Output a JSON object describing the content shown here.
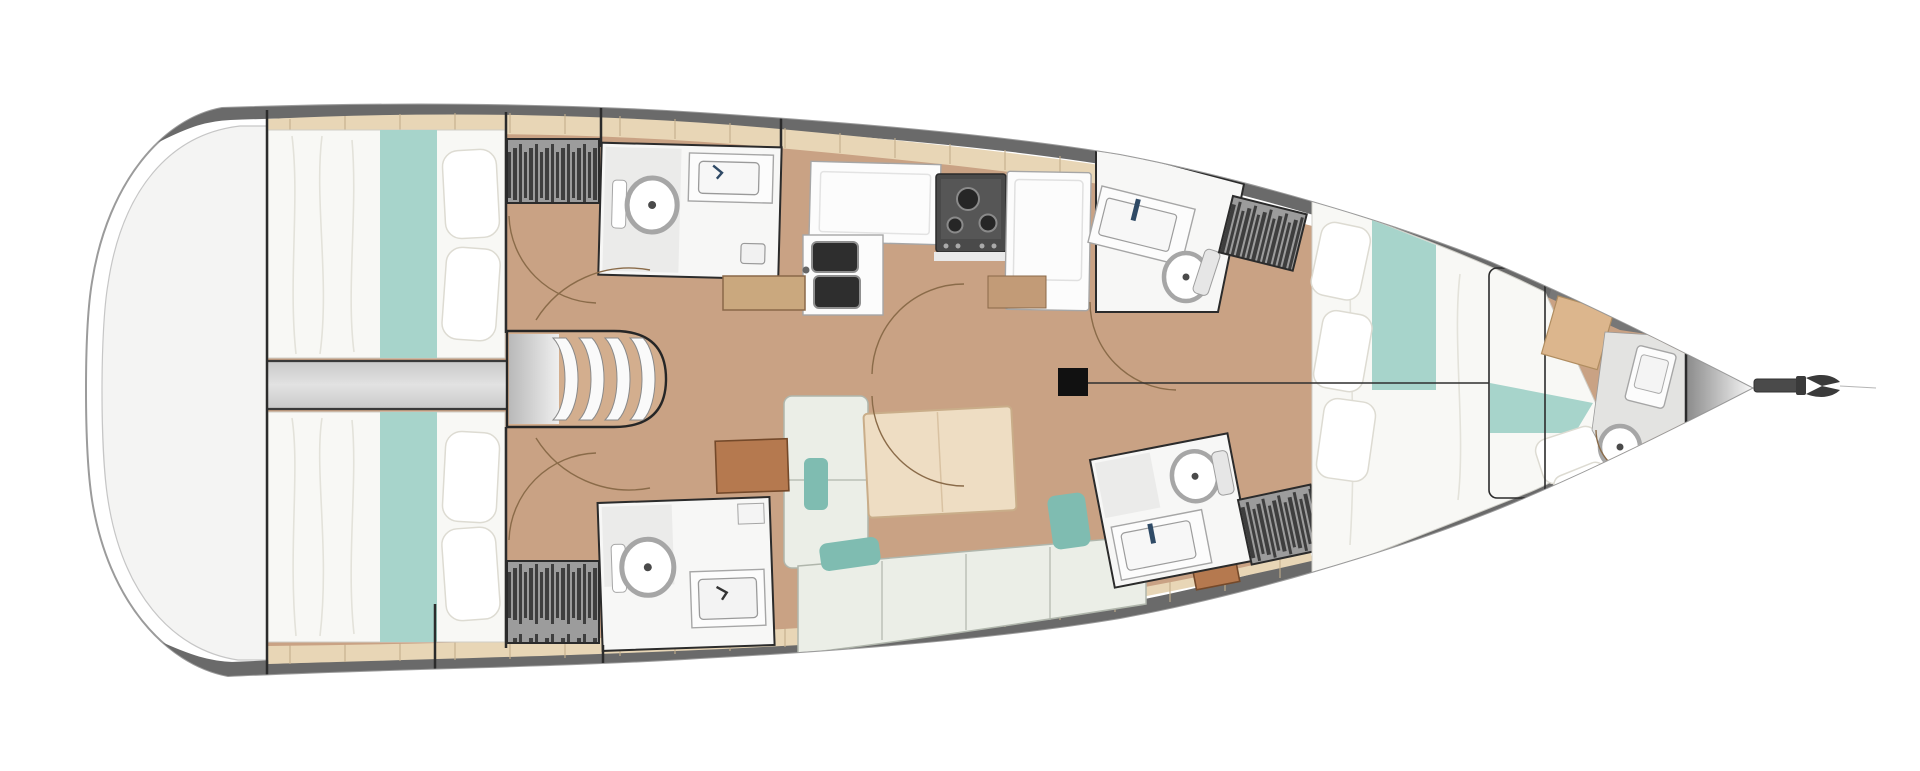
{
  "plan": {
    "type": "sailing-yacht-interior-floor-plan",
    "view": "top-down",
    "orientation": {
      "stern": "left",
      "bow": "right"
    },
    "rooms": [
      {
        "id": "cockpit-transom",
        "features": [
          "open-deck"
        ]
      },
      {
        "id": "aft-cabin-port",
        "features": [
          "double-berth",
          "teal-runner",
          "pillows",
          "hanging-locker"
        ]
      },
      {
        "id": "aft-cabin-starboard",
        "features": [
          "double-berth",
          "teal-runner",
          "pillows",
          "hanging-locker"
        ]
      },
      {
        "id": "engine-compartment",
        "features": [
          "companionway-steps"
        ]
      },
      {
        "id": "head-aft-port",
        "features": [
          "toilet",
          "sink",
          "shower-drain"
        ]
      },
      {
        "id": "head-aft-starboard",
        "features": [
          "toilet",
          "sink",
          "shelf"
        ]
      },
      {
        "id": "galley",
        "features": [
          "double-sink",
          "stove",
          "counter",
          "refrigerator",
          "sideboard"
        ]
      },
      {
        "id": "salon",
        "features": [
          "u-shaped-settee",
          "folding-table",
          "teal-cushions",
          "nav-desk",
          "side-table"
        ]
      },
      {
        "id": "head-forward-port",
        "features": [
          "toilet",
          "sink-counter",
          "hanging-locker"
        ]
      },
      {
        "id": "head-forward-starboard",
        "features": [
          "toilet",
          "sink-counter",
          "hanging-locker"
        ]
      },
      {
        "id": "forward-cabin",
        "features": [
          "island-double-berth",
          "teal-runner",
          "pillows",
          "deck-hatch",
          "vanity"
        ]
      },
      {
        "id": "bow-head",
        "features": [
          "toilet",
          "basin"
        ]
      },
      {
        "id": "anchor-locker",
        "features": [
          "bowsprit",
          "anchor"
        ]
      }
    ],
    "counts": {
      "cabins": 3,
      "double_berths": 3,
      "toilets": 5,
      "hanging_lockers": 4,
      "companionway_steps": 4
    },
    "mast": {
      "present": true,
      "centerline_to_bow": true
    }
  },
  "colors": {
    "background": "#ffffff",
    "hull_fill": "#ffffff",
    "hull_stroke": "#9b9b9b",
    "deck_band": "#6a6a6a",
    "transom_fill": "#f4f4f3",
    "transom_stroke": "#c6c6c6",
    "side_deck": "#e8d6b6",
    "deck_seam": "#c3ae8c",
    "floor_wood": "#c9a284",
    "floor_wood_light": "#d3ae8e",
    "bedding": "#f8f8f5",
    "bedding_fold": "#e3e2da",
    "pillow": "#ffffff",
    "pillow_stroke": "#dddbd2",
    "teal": "#a7d4cb",
    "teal_dark": "#7fbcb1",
    "wall": "#2b2b2b",
    "head_fill": "#f7f7f6",
    "head_shade": "#ebebea",
    "fixture_stroke": "#a6a6a6",
    "counter": "#fcfcfc",
    "sink_dark": "#2e2e2e",
    "stove": "#4a4a4a",
    "stove_burner": "#262626",
    "table_wood": "#eeddc3",
    "table_stroke": "#c9ad89",
    "desk": "#b5794f",
    "desk_stroke": "#74492a",
    "settee": "#ebeee7",
    "settee_stroke": "#b0b6ac",
    "locker": "#9c9c9c",
    "locker_bar": "#3e3e3e",
    "tread": "#fafafa",
    "tread_stroke": "#8a8a8a",
    "divider": "#e2e2e2",
    "vanity": "#dcb68d",
    "vanity_stroke": "#b08d60",
    "bow_gray": "#8a8a8a",
    "door_arc": "#8a6b49",
    "faucet": "#2f4a66",
    "mast": "#111111",
    "anchor": "#3a3a3a"
  }
}
